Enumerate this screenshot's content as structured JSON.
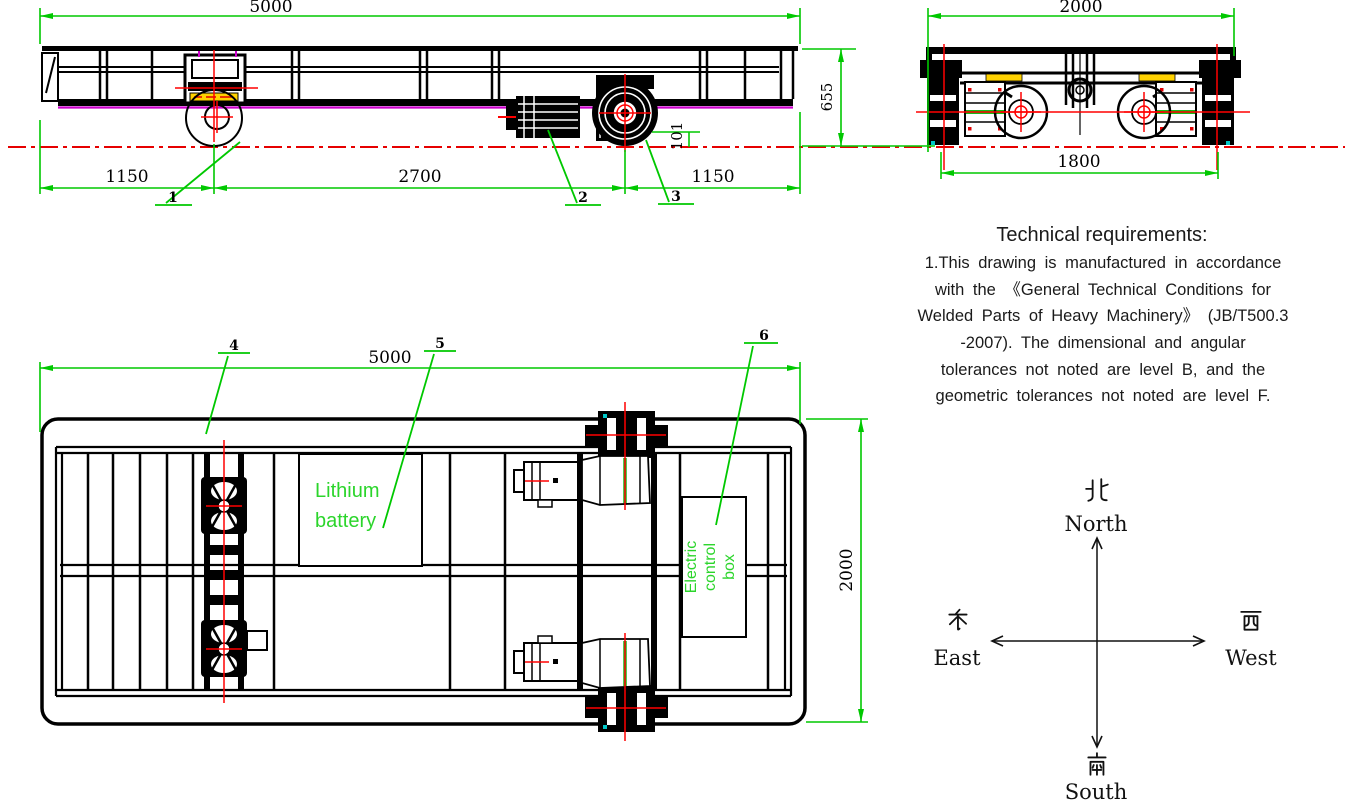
{
  "colors": {
    "dim_green": "#00c800",
    "text_green": "#2bd52b",
    "centerline_red": "#ff0000",
    "chord_magenta": "#cc00cc",
    "detail_yellow": "#ffd200",
    "detail_cyan": "#00c8c8",
    "line_black": "#000000"
  },
  "side_view": {
    "dim_overall_length": "5000",
    "dim_left_overhang": "1150",
    "dim_wheelbase": "2700",
    "dim_right_overhang": "1150",
    "dim_wheel_drop": "101",
    "dim_height": "655",
    "callout_1": "1",
    "callout_2": "2",
    "callout_3": "3"
  },
  "end_view": {
    "dim_overall_width": "2000",
    "dim_rail_gauge": "1800"
  },
  "plan_view": {
    "dim_length": "5000",
    "dim_width": "2000",
    "callout_4": "4",
    "callout_5": "5",
    "callout_6": "6",
    "battery_label_line1": "Lithium",
    "battery_label_line2": "battery",
    "control_box_line1": "Electric",
    "control_box_line2": "control",
    "control_box_line3": "box"
  },
  "technical_requirements": {
    "heading": "Technical requirements:",
    "line1": "1.This drawing is manufactured in accordance",
    "line2": "with the 《General Technical Conditions for",
    "line3": "Welded Parts of Heavy Machinery》 (JB/T500.3",
    "line4": "-2007). The dimensional and angular",
    "line5": "tolerances not noted are level B, and the",
    "line6": "geometric tolerances not noted are level F."
  },
  "compass": {
    "north_cjk": "北",
    "north_en": "North",
    "south_cjk": "南",
    "south_en": "South",
    "east_cjk": "东",
    "east_en": "East",
    "west_cjk": "西",
    "west_en": "West"
  }
}
